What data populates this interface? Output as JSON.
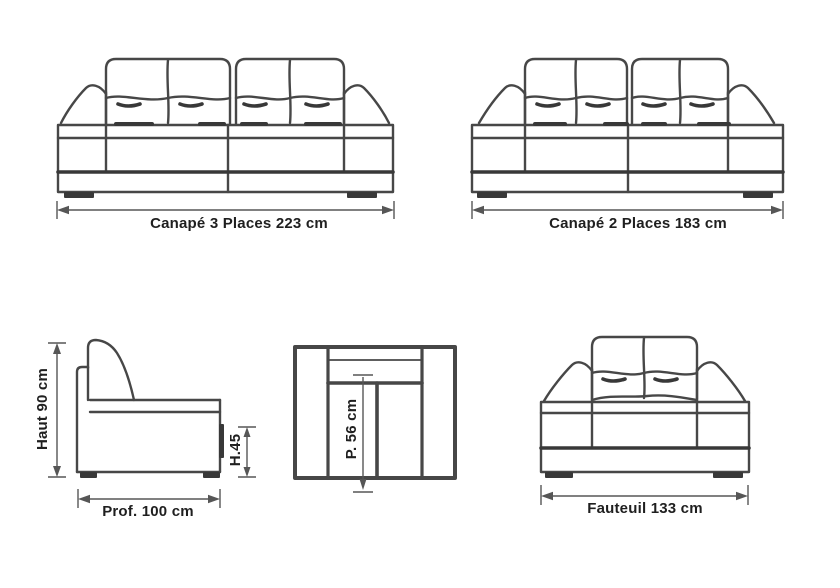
{
  "diagram": {
    "background": "#ffffff",
    "line_color": "#474747",
    "accent_dark": "#383838",
    "dimension_color": "#565656",
    "text_color": "#1f1f1f",
    "sofa3": {
      "label": "Canapé 3 Places 223 cm"
    },
    "sofa2": {
      "label": "Canapé 2 Places 183 cm"
    },
    "side_view": {
      "height_label": "Haut 90 cm",
      "seat_height_label": "H.45",
      "depth_label": "Prof. 100 cm"
    },
    "top_view": {
      "seat_depth_label": "P. 56 cm"
    },
    "armchair": {
      "label": "Fauteuil 133 cm"
    }
  }
}
